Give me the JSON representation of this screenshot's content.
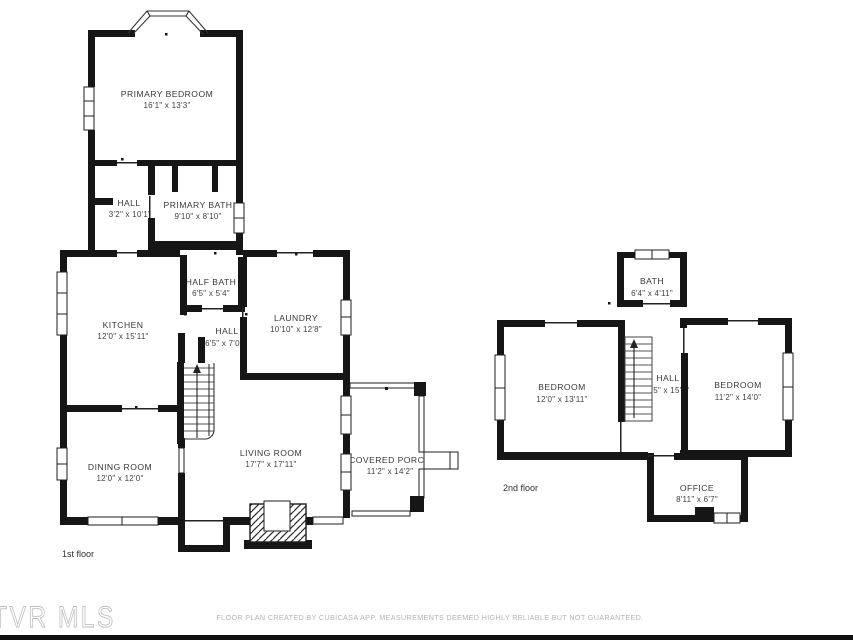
{
  "colors": {
    "background": "#ffffff",
    "walls": "#161616",
    "room_labels": "#3a3a3a",
    "disclaimer_text": "#b3b3b3",
    "watermark_text": "#bdbdbd"
  },
  "watermark": {
    "text": "TVR MLS"
  },
  "footer": {
    "disclaimer": "FLOOR PLAN CREATED BY CUBICASA APP. MEASUREMENTS DEEMED HIGHLY RELIABLE BUT NOT GUARANTEED."
  },
  "floors": {
    "first": {
      "label": "1st floor",
      "rooms": {
        "primary_bedroom": {
          "name": "PRIMARY BEDROOM",
          "dims": "16'1\" x 13'3\""
        },
        "hall": {
          "name": "HALL",
          "dims": "3'2\" x 10'1\""
        },
        "primary_bath": {
          "name": "PRIMARY BATH",
          "dims": "9'10\" x 8'10\""
        },
        "half_bath": {
          "name": "HALF BATH",
          "dims": "6'5\" x 5'4\""
        },
        "kitchen": {
          "name": "KITCHEN",
          "dims": "12'0\" x 15'11\""
        },
        "main_hall": {
          "name": "HALL",
          "dims": "6'5\" x 7'0\""
        },
        "laundry": {
          "name": "LAUNDRY",
          "dims": "10'10\" x 12'8\""
        },
        "dining_room": {
          "name": "DINING ROOM",
          "dims": "12'0\" x 12'0\""
        },
        "living_room": {
          "name": "LIVING ROOM",
          "dims": "17'7\" x 17'11\""
        },
        "covered_porch": {
          "name": "COVERED PORCH",
          "dims": "11'2\" x 14'2\""
        }
      }
    },
    "second": {
      "label": "2nd floor",
      "rooms": {
        "bath": {
          "name": "BATH",
          "dims": "6'4\" x 4'11\""
        },
        "bedroom_left": {
          "name": "BEDROOM",
          "dims": "12'0\" x 13'11\""
        },
        "hall": {
          "name": "HALL",
          "dims": "6'5\" x 15'9\""
        },
        "bedroom_right": {
          "name": "BEDROOM",
          "dims": "11'2\" x 14'0\""
        },
        "office": {
          "name": "OFFICE",
          "dims": "8'11\" x 6'7\""
        }
      }
    }
  }
}
